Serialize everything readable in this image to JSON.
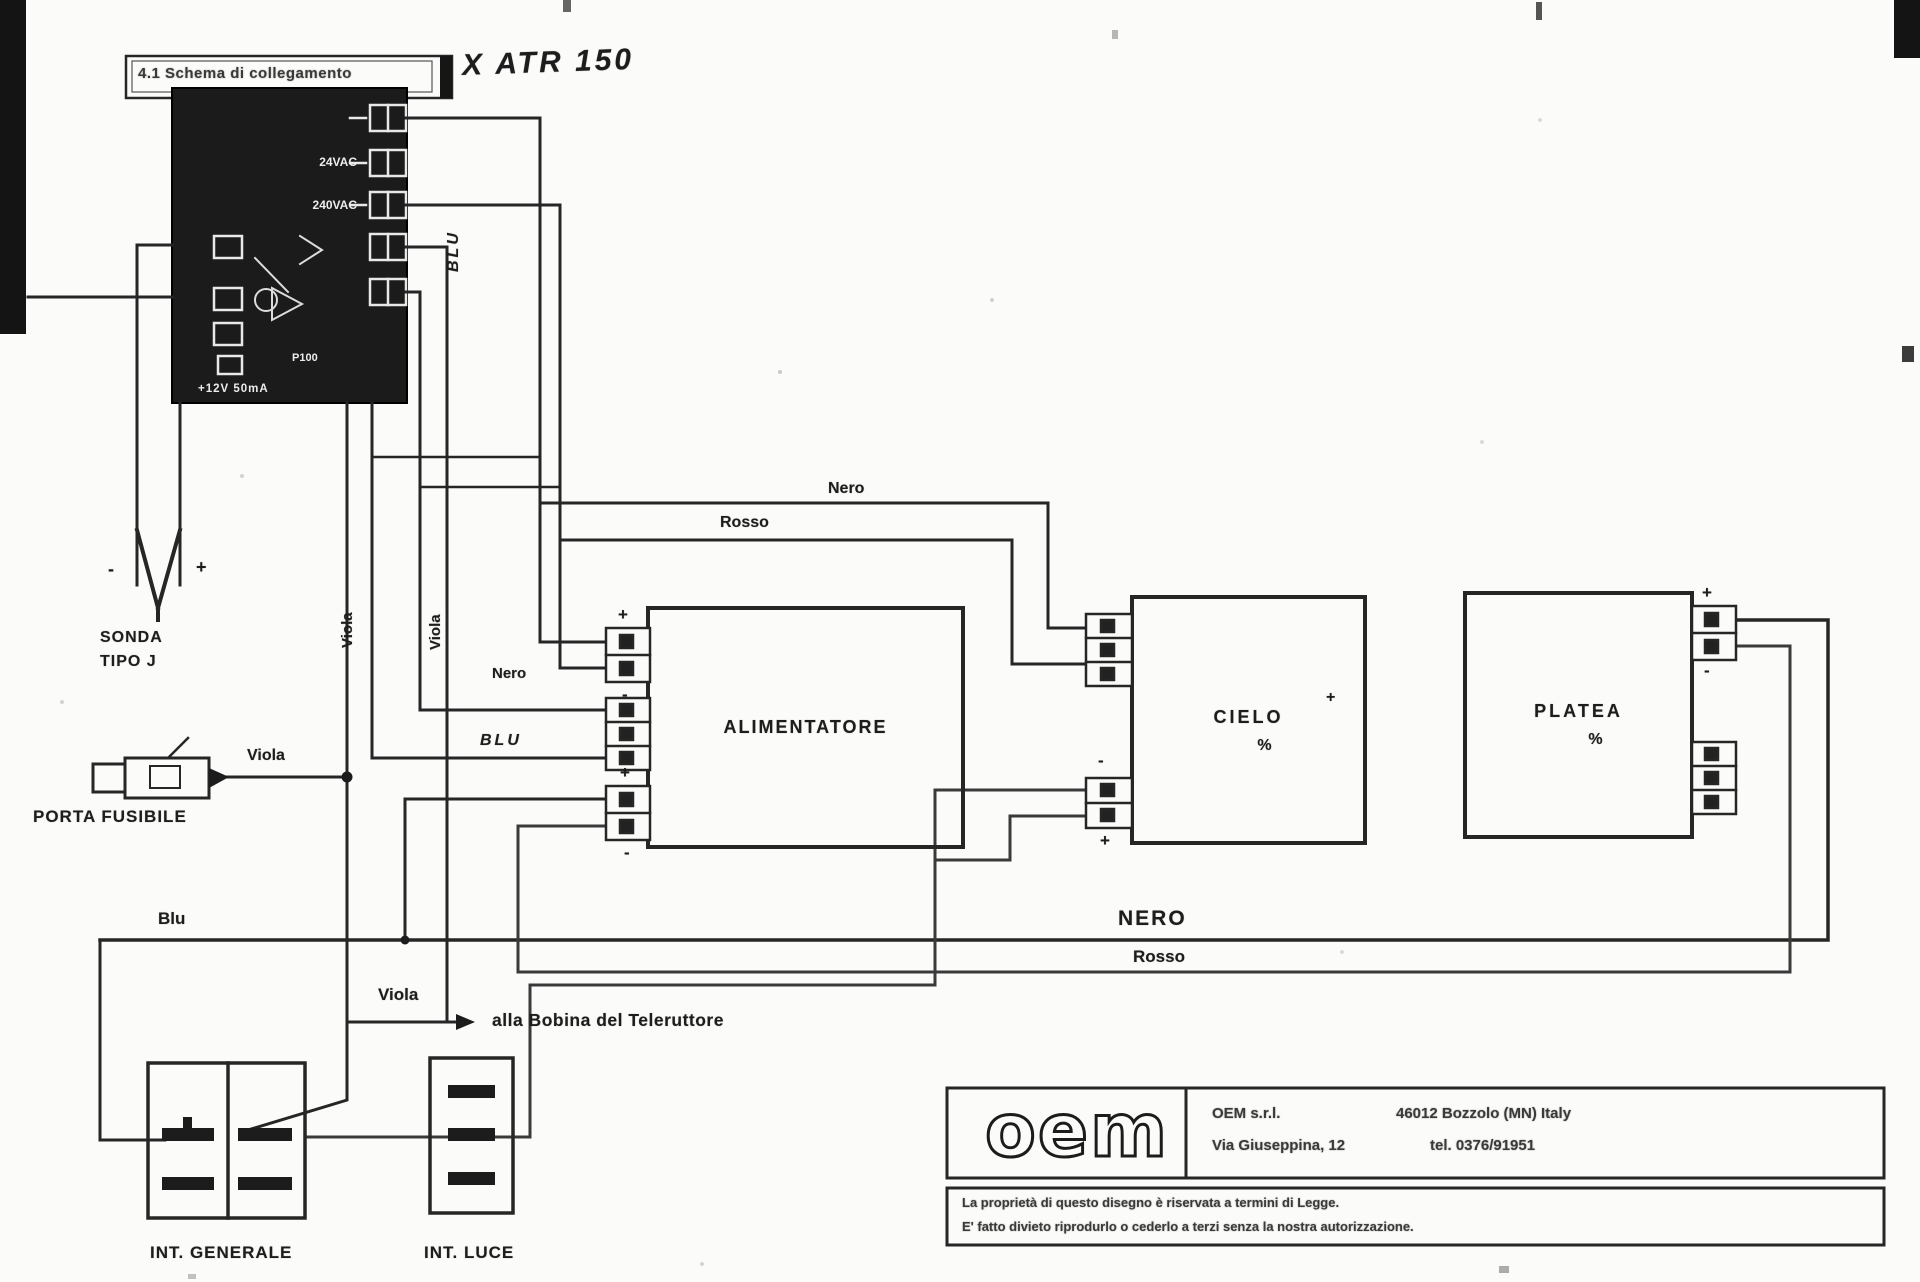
{
  "header": {
    "section_label": "4.1 Schema di collegamento",
    "handwritten_model": "X ATR 150"
  },
  "controller": {
    "label_24vac": "24VAC",
    "label_240vac": "240VAC",
    "label_internal": "P100",
    "label_supply": "+12V  50mA"
  },
  "probe": {
    "name_line1": "SONDA",
    "name_line2": "TIPO J"
  },
  "fuse": {
    "label": "PORTA FUSIBILE",
    "wire_label": "Viola"
  },
  "wires": {
    "viola_vertical_1": "Viola",
    "viola_vertical_2": "Viola",
    "blu_handwritten": "BLU",
    "blu_alim": "BLU",
    "nero_alim": "Nero",
    "nero_top": "Nero",
    "rosso_top": "Rosso",
    "blu_bottom": "Blu",
    "nero_bottom": "NERO",
    "rosso_bottom": "Rosso",
    "viola_bobina": "Viola",
    "bobina_note": "alla Bobina del Teleruttore"
  },
  "units": {
    "alimentatore": "ALIMENTATORE",
    "cielo": "CIELO",
    "cielo_mark": "%",
    "platea": "PLATEA",
    "platea_mark": "%"
  },
  "marks": {
    "plus": "+",
    "minus": "-"
  },
  "switches": {
    "generale": "INT. GENERALE",
    "luce": "INT. LUCE"
  },
  "oem": {
    "logo": "oem",
    "company": "OEM s.r.l.",
    "address_right": "46012 Bozzolo (MN) Italy",
    "address_left": "Via Giuseppina, 12",
    "phone": "tel. 0376/91951",
    "legal_line1": "La proprietà di questo disegno è riservata a termini di Legge.",
    "legal_line2": "E' fatto divieto riprodurlo o cederlo a terzi senza la nostra autorizzazione."
  }
}
